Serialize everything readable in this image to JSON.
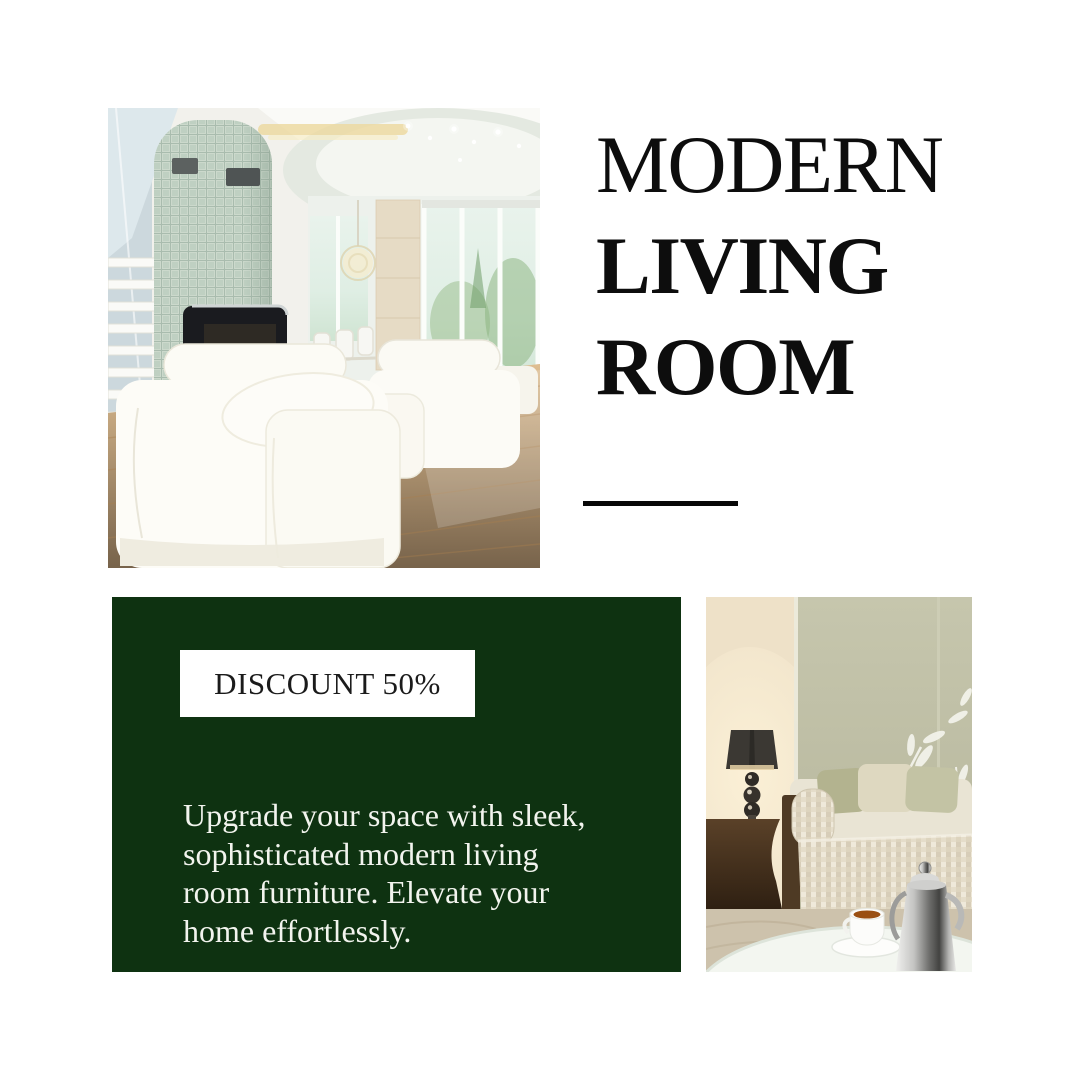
{
  "colors": {
    "accent_green": "#0e3211",
    "title_black": "#0d0d0d",
    "badge_bg": "#ffffff",
    "badge_text": "#1b1b1b",
    "body_text": "#f2f4ee",
    "rule_black": "#070707",
    "canvas_bg": "#ffffff"
  },
  "title": {
    "lines": {
      "0": {
        "text": "MODERN"
      },
      "1": {
        "text": "LIVING"
      },
      "2": {
        "text": "ROOM"
      }
    }
  },
  "promo": {
    "badge_label": "DISCOUNT 50%",
    "body_lines": {
      "0": "Upgrade your space with sleek,",
      "1": "sophisticated modern living",
      "2": "room furniture. Elevate your",
      "3": "home effortlessly."
    }
  },
  "images": {
    "top_left_alt": "Bright modern living room with white leather sofas, mosaic fireplace column and large windows",
    "bottom_right_alt": "Beige sofa with pillows, dark lamp side table and glass coffee table with tea set"
  }
}
